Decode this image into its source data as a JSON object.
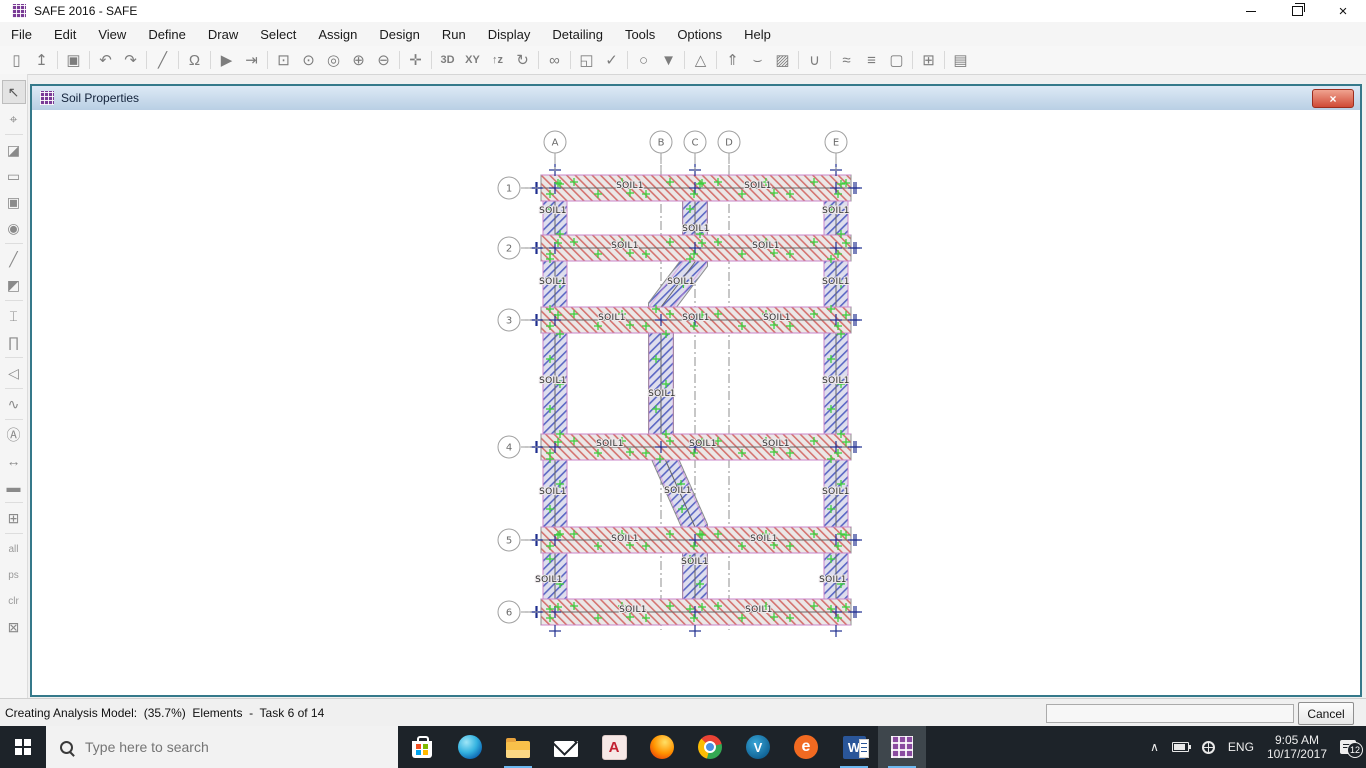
{
  "window": {
    "title": "SAFE 2016 - SAFE"
  },
  "menu": {
    "items": [
      "File",
      "Edit",
      "View",
      "Define",
      "Draw",
      "Select",
      "Assign",
      "Design",
      "Run",
      "Display",
      "Detailing",
      "Tools",
      "Options",
      "Help"
    ]
  },
  "toolbar": {
    "items": [
      {
        "name": "new-model",
        "glyph": "▯"
      },
      {
        "name": "open-file",
        "glyph": "↥"
      },
      {
        "sep": true
      },
      {
        "name": "save",
        "glyph": "▣"
      },
      {
        "sep": true
      },
      {
        "name": "undo",
        "glyph": "↶"
      },
      {
        "name": "redo",
        "glyph": "↷"
      },
      {
        "sep": true
      },
      {
        "name": "draw-line",
        "glyph": "╱"
      },
      {
        "sep": true
      },
      {
        "name": "lock-model",
        "glyph": "Ω"
      },
      {
        "sep": true
      },
      {
        "name": "run-analysis",
        "glyph": "▶"
      },
      {
        "name": "run-to-wall",
        "glyph": "⇥"
      },
      {
        "sep": true
      },
      {
        "name": "rubber-band-zoom",
        "glyph": "⊡"
      },
      {
        "name": "restore-full-view",
        "glyph": "⊙"
      },
      {
        "name": "previous-zoom",
        "glyph": "◎"
      },
      {
        "name": "zoom-in",
        "glyph": "⊕"
      },
      {
        "name": "zoom-out",
        "glyph": "⊖"
      },
      {
        "sep": true
      },
      {
        "name": "pan",
        "glyph": "✛"
      },
      {
        "sep": true
      },
      {
        "name": "view-3d",
        "text": "3D"
      },
      {
        "name": "view-xy",
        "text": "XY"
      },
      {
        "name": "view-z",
        "text": "↑z"
      },
      {
        "name": "rotate-view",
        "glyph": "↻"
      },
      {
        "sep": true
      },
      {
        "name": "named-views",
        "glyph": "∞"
      },
      {
        "sep": true
      },
      {
        "name": "shrink-objects",
        "glyph": "◱"
      },
      {
        "name": "check-model",
        "glyph": "✓"
      },
      {
        "sep": true
      },
      {
        "name": "object-ring",
        "glyph": "○"
      },
      {
        "name": "assign-down",
        "glyph": "▼"
      },
      {
        "sep": true
      },
      {
        "name": "mesh-options",
        "glyph": "△"
      },
      {
        "sep": true
      },
      {
        "name": "support-display",
        "glyph": "⇑"
      },
      {
        "name": "deformed-shape",
        "glyph": "⌣"
      },
      {
        "name": "display-image",
        "glyph": "▨"
      },
      {
        "sep": true
      },
      {
        "name": "show-forces",
        "glyph": "∪"
      },
      {
        "sep": true
      },
      {
        "name": "design-strips",
        "glyph": "≈"
      },
      {
        "name": "display-options",
        "glyph": "≡"
      },
      {
        "name": "select-region",
        "glyph": "▢"
      },
      {
        "sep": true
      },
      {
        "name": "show-grid",
        "glyph": "⊞"
      },
      {
        "sep": true
      },
      {
        "name": "report",
        "glyph": "▤"
      }
    ]
  },
  "left_toolbar": {
    "items": [
      {
        "name": "select-pointer",
        "glyph": "↖",
        "active": true
      },
      {
        "name": "reshape-object",
        "glyph": "⌖"
      },
      {
        "sep": true
      },
      {
        "name": "draw-slab",
        "glyph": "◪"
      },
      {
        "name": "draw-rect-slab",
        "glyph": "▭"
      },
      {
        "name": "quick-draw-area",
        "glyph": "▣"
      },
      {
        "name": "draw-circle-area",
        "glyph": "◉"
      },
      {
        "sep": true
      },
      {
        "name": "draw-beam",
        "glyph": "╱"
      },
      {
        "name": "quick-draw-beam",
        "glyph": "◩"
      },
      {
        "sep": true
      },
      {
        "name": "draw-column",
        "glyph": "⌶"
      },
      {
        "name": "draw-wall",
        "glyph": "∏"
      },
      {
        "sep": true
      },
      {
        "name": "draw-ramp",
        "glyph": "◁"
      },
      {
        "sep": true
      },
      {
        "name": "draw-curve",
        "glyph": "∿"
      },
      {
        "sep": true
      },
      {
        "name": "assign-label",
        "glyph": "Ⓐ"
      },
      {
        "name": "draw-dimension",
        "glyph": "↔"
      },
      {
        "name": "draw-design-strip",
        "glyph": "▬"
      },
      {
        "sep": true
      },
      {
        "name": "set-view-window",
        "glyph": "⊞"
      },
      {
        "sep": true
      },
      {
        "name": "select-all",
        "text": "all"
      },
      {
        "name": "previous-selection",
        "text": "ps"
      },
      {
        "name": "clear-selection",
        "text": "clr"
      },
      {
        "name": "deselect",
        "glyph": "⊠"
      }
    ]
  },
  "inner_window": {
    "title": "Soil Properties"
  },
  "drawing": {
    "soil_label_text": "SOIL1",
    "columns": [
      {
        "label": "A",
        "x": 555
      },
      {
        "label": "B",
        "x": 661
      },
      {
        "label": "C",
        "x": 695
      },
      {
        "label": "D",
        "x": 729
      },
      {
        "label": "E",
        "x": 836
      }
    ],
    "rows": [
      {
        "label": "1",
        "y": 188
      },
      {
        "label": "2",
        "y": 248
      },
      {
        "label": "3",
        "y": 320
      },
      {
        "label": "4",
        "y": 447
      },
      {
        "label": "5",
        "y": 540
      },
      {
        "label": "6",
        "y": 612
      }
    ],
    "soil_labels": [
      {
        "x": 630,
        "y": 185
      },
      {
        "x": 758,
        "y": 185
      },
      {
        "x": 553,
        "y": 210
      },
      {
        "x": 836,
        "y": 210
      },
      {
        "x": 696,
        "y": 228
      },
      {
        "x": 625,
        "y": 245
      },
      {
        "x": 766,
        "y": 245
      },
      {
        "x": 553,
        "y": 281
      },
      {
        "x": 681,
        "y": 281
      },
      {
        "x": 836,
        "y": 281
      },
      {
        "x": 612,
        "y": 317
      },
      {
        "x": 696,
        "y": 317
      },
      {
        "x": 777,
        "y": 317
      },
      {
        "x": 553,
        "y": 380
      },
      {
        "x": 662,
        "y": 393
      },
      {
        "x": 836,
        "y": 380
      },
      {
        "x": 610,
        "y": 443
      },
      {
        "x": 703,
        "y": 443
      },
      {
        "x": 776,
        "y": 443
      },
      {
        "x": 553,
        "y": 491
      },
      {
        "x": 678,
        "y": 490
      },
      {
        "x": 836,
        "y": 491
      },
      {
        "x": 625,
        "y": 538
      },
      {
        "x": 764,
        "y": 538
      },
      {
        "x": 695,
        "y": 561
      },
      {
        "x": 549,
        "y": 579
      },
      {
        "x": 833,
        "y": 579
      },
      {
        "x": 633,
        "y": 609
      },
      {
        "x": 759,
        "y": 609
      }
    ]
  },
  "status_bar": {
    "text": "Creating Analysis Model:  (35.7%)  Elements  -  Task 6 of 14",
    "cancel_label": "Cancel"
  },
  "taskbar": {
    "search_placeholder": "Type here to search",
    "apps": [
      {
        "name": "microsoft-store"
      },
      {
        "name": "edge"
      },
      {
        "name": "file-explorer",
        "underline": true
      },
      {
        "name": "mail"
      },
      {
        "name": "autocad",
        "label": "A"
      },
      {
        "name": "firefox"
      },
      {
        "name": "chrome"
      },
      {
        "name": "v-player",
        "label": "V"
      },
      {
        "name": "internet-explorer",
        "label": "e"
      },
      {
        "name": "word",
        "label": "W",
        "underline": true
      },
      {
        "name": "safe",
        "underline": true,
        "active": true
      }
    ],
    "tray": {
      "language": "ENG",
      "time": "9:05 AM",
      "date": "10/17/2017",
      "notification_count": "12"
    }
  },
  "colors": {
    "accent_purple": "#7a3b96",
    "strip_fill_red": "#ebe7e7",
    "strip_hatch_red": "#d4736f",
    "strip_fill_blue": "#dedeed",
    "strip_hatch_blue": "#5b68c4",
    "strip_edge_magenta": "#d983d9",
    "marker_green": "#3fcf3f",
    "tick_navy": "#1f2e8f",
    "inner_border_teal": "#35798a",
    "taskbar_bg": "#1d2329",
    "underline_blue": "#6cb8f0"
  }
}
